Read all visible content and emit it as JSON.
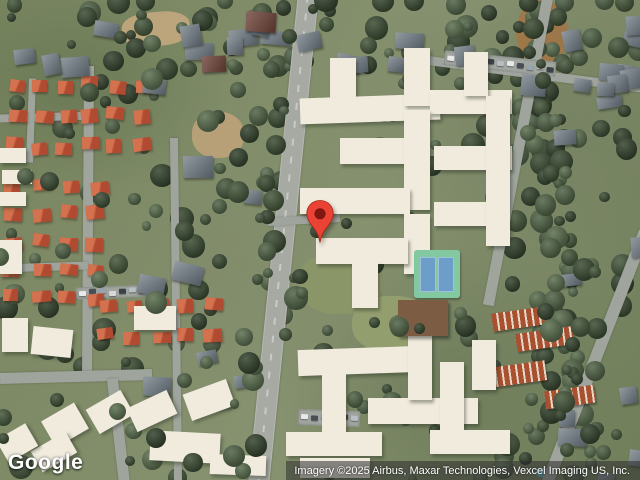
{
  "map": {
    "logo": "Google",
    "attribution": "Imagery ©2025 Airbus, Maxar Technologies, Vexcel Imaging US, Inc."
  },
  "marker": {
    "pin_color": "#EA4335",
    "pin_border": "#A52714",
    "dot_color": "#7E1710"
  },
  "features": {
    "roads": [
      [
        308,
        -6,
        258,
        486,
        19,
        "main"
      ],
      [
        89,
        66,
        87,
        376,
        10,
        ""
      ],
      [
        0,
        378,
        152,
        374,
        11,
        ""
      ],
      [
        112,
        378,
        124,
        482,
        11,
        ""
      ],
      [
        174,
        138,
        178,
        482,
        8,
        ""
      ],
      [
        548,
        -6,
        488,
        305,
        11,
        ""
      ],
      [
        645,
        232,
        548,
        482,
        12,
        ""
      ],
      [
        428,
        60,
        645,
        88,
        9,
        ""
      ],
      [
        268,
        222,
        340,
        218,
        8,
        ""
      ],
      [
        0,
        118,
        95,
        115,
        8,
        ""
      ],
      [
        33,
        78,
        30,
        162,
        7,
        ""
      ],
      [
        0,
        268,
        88,
        265,
        8,
        ""
      ]
    ],
    "apartment_buildings": [
      [
        330,
        58,
        26,
        48,
        0
      ],
      [
        300,
        96,
        140,
        26,
        -2
      ],
      [
        404,
        48,
        26,
        58,
        0
      ],
      [
        430,
        90,
        82,
        24,
        0
      ],
      [
        464,
        52,
        24,
        44,
        0
      ],
      [
        340,
        138,
        72,
        26,
        0
      ],
      [
        404,
        110,
        26,
        100,
        0
      ],
      [
        434,
        146,
        78,
        24,
        0
      ],
      [
        300,
        188,
        110,
        26,
        0
      ],
      [
        404,
        214,
        26,
        60,
        0
      ],
      [
        434,
        202,
        72,
        24,
        0
      ],
      [
        316,
        238,
        92,
        26,
        0
      ],
      [
        352,
        262,
        26,
        46,
        0
      ],
      [
        486,
        96,
        24,
        150,
        0
      ],
      [
        298,
        348,
        120,
        26,
        -2
      ],
      [
        322,
        374,
        24,
        60,
        0
      ],
      [
        286,
        432,
        96,
        24,
        0
      ],
      [
        368,
        398,
        110,
        26,
        0
      ],
      [
        408,
        336,
        24,
        64,
        0
      ],
      [
        440,
        362,
        24,
        70,
        0
      ],
      [
        300,
        458,
        70,
        20,
        0
      ],
      [
        430,
        430,
        80,
        24,
        0
      ],
      [
        472,
        340,
        24,
        50,
        0
      ],
      [
        2,
        318,
        26,
        34,
        0
      ],
      [
        32,
        328,
        40,
        28,
        6
      ],
      [
        134,
        306,
        42,
        24,
        0
      ],
      [
        46,
        410,
        38,
        30,
        -30
      ],
      [
        90,
        398,
        40,
        28,
        -30
      ],
      [
        130,
        398,
        44,
        26,
        -25
      ],
      [
        186,
        386,
        46,
        28,
        -20
      ],
      [
        150,
        432,
        70,
        30,
        3
      ],
      [
        34,
        440,
        40,
        24,
        -30
      ],
      [
        0,
        430,
        34,
        26,
        -30
      ],
      [
        0,
        148,
        26,
        15,
        0
      ],
      [
        2,
        170,
        30,
        14,
        0
      ],
      [
        0,
        192,
        26,
        14,
        0
      ],
      [
        0,
        240,
        22,
        34,
        0
      ],
      [
        210,
        455,
        56,
        20,
        2
      ]
    ],
    "gray_house_areas": [
      [
        0,
        2,
        250,
        55,
        8
      ],
      [
        320,
        4,
        150,
        60,
        5
      ],
      [
        555,
        0,
        85,
        135,
        6
      ],
      [
        130,
        75,
        115,
        330,
        9
      ],
      [
        520,
        60,
        118,
        235,
        8
      ],
      [
        520,
        380,
        118,
        95,
        5
      ],
      [
        228,
        2,
        90,
        65,
        3
      ]
    ],
    "red_roof_grids": [
      [
        8,
        78,
        6,
        3,
        25,
        31
      ],
      [
        4,
        180,
        4,
        5,
        28,
        28
      ],
      [
        98,
        300,
        5,
        2,
        27,
        31
      ]
    ],
    "brown_houses": [
      [
        246,
        12,
        30,
        20,
        4
      ],
      [
        202,
        56,
        24,
        16,
        -3
      ]
    ],
    "striped_rows": [
      [
        492,
        310,
        54,
        18,
        -8
      ],
      [
        516,
        330,
        58,
        18,
        -8
      ],
      [
        490,
        364,
        56,
        20,
        -8
      ],
      [
        545,
        388,
        50,
        18,
        -8
      ]
    ],
    "ground_patches": [
      [
        122,
        12,
        68,
        34,
        "#c3a87e",
        -5,
        "40%",
        0.9
      ],
      [
        192,
        112,
        52,
        46,
        "#bda27a",
        0,
        "45%",
        0.9
      ],
      [
        516,
        0,
        52,
        66,
        "#a8713f",
        0,
        "50%",
        0.75
      ],
      [
        298,
        252,
        84,
        62,
        "#8b9668",
        0,
        "45%",
        1
      ],
      [
        352,
        296,
        80,
        56,
        "#939e6e",
        0,
        "45%",
        1
      ],
      [
        368,
        348,
        20,
        13,
        "#6fc0cf",
        0,
        "40%",
        1
      ],
      [
        46,
        452,
        16,
        10,
        "#6fc0cf",
        0,
        "40%",
        1
      ],
      [
        536,
        468,
        14,
        9,
        "#5fb6c8",
        0,
        "40%",
        1
      ]
    ],
    "parking_lots": [
      [
        444,
        56,
        112,
        15,
        6
      ],
      [
        76,
        286,
        76,
        12,
        -2
      ],
      [
        298,
        410,
        62,
        16,
        2
      ]
    ],
    "car_colors": [
      "#e9e9e9",
      "#474e55",
      "#97a3ae",
      "#d8d8d8",
      "#3a4147",
      "#b8bec4"
    ],
    "tennis_court": {
      "x": 414,
      "y": 250,
      "w": 46,
      "h": 48,
      "rim": "#82c9a2",
      "court": "#6d9ec9"
    },
    "clubhouse": {
      "x": 398,
      "y": 300,
      "w": 50,
      "h": 36,
      "color": "#7d5c44"
    },
    "trees": {
      "uniform_under": 150,
      "uniform_over": 85,
      "corridor": {
        "x1": 528,
        "y1": 0,
        "x2": 578,
        "y2": 480,
        "n": 55,
        "spread": 20
      },
      "roadside": {
        "x1": 308,
        "y1": 0,
        "x2": 258,
        "y2": 480,
        "n": 45
      },
      "top_band": {
        "x": 0,
        "y": 0,
        "w": 640,
        "h": 70,
        "n": 40
      },
      "colors": [
        "#3d4e35",
        "#47593d",
        "#526548",
        "#5c7050",
        "#36452f"
      ],
      "exclude": [
        [
          295,
          40,
          228,
          228
        ],
        [
          275,
          335,
          252,
          140
        ],
        [
          408,
          244,
          62,
          60
        ]
      ]
    }
  }
}
